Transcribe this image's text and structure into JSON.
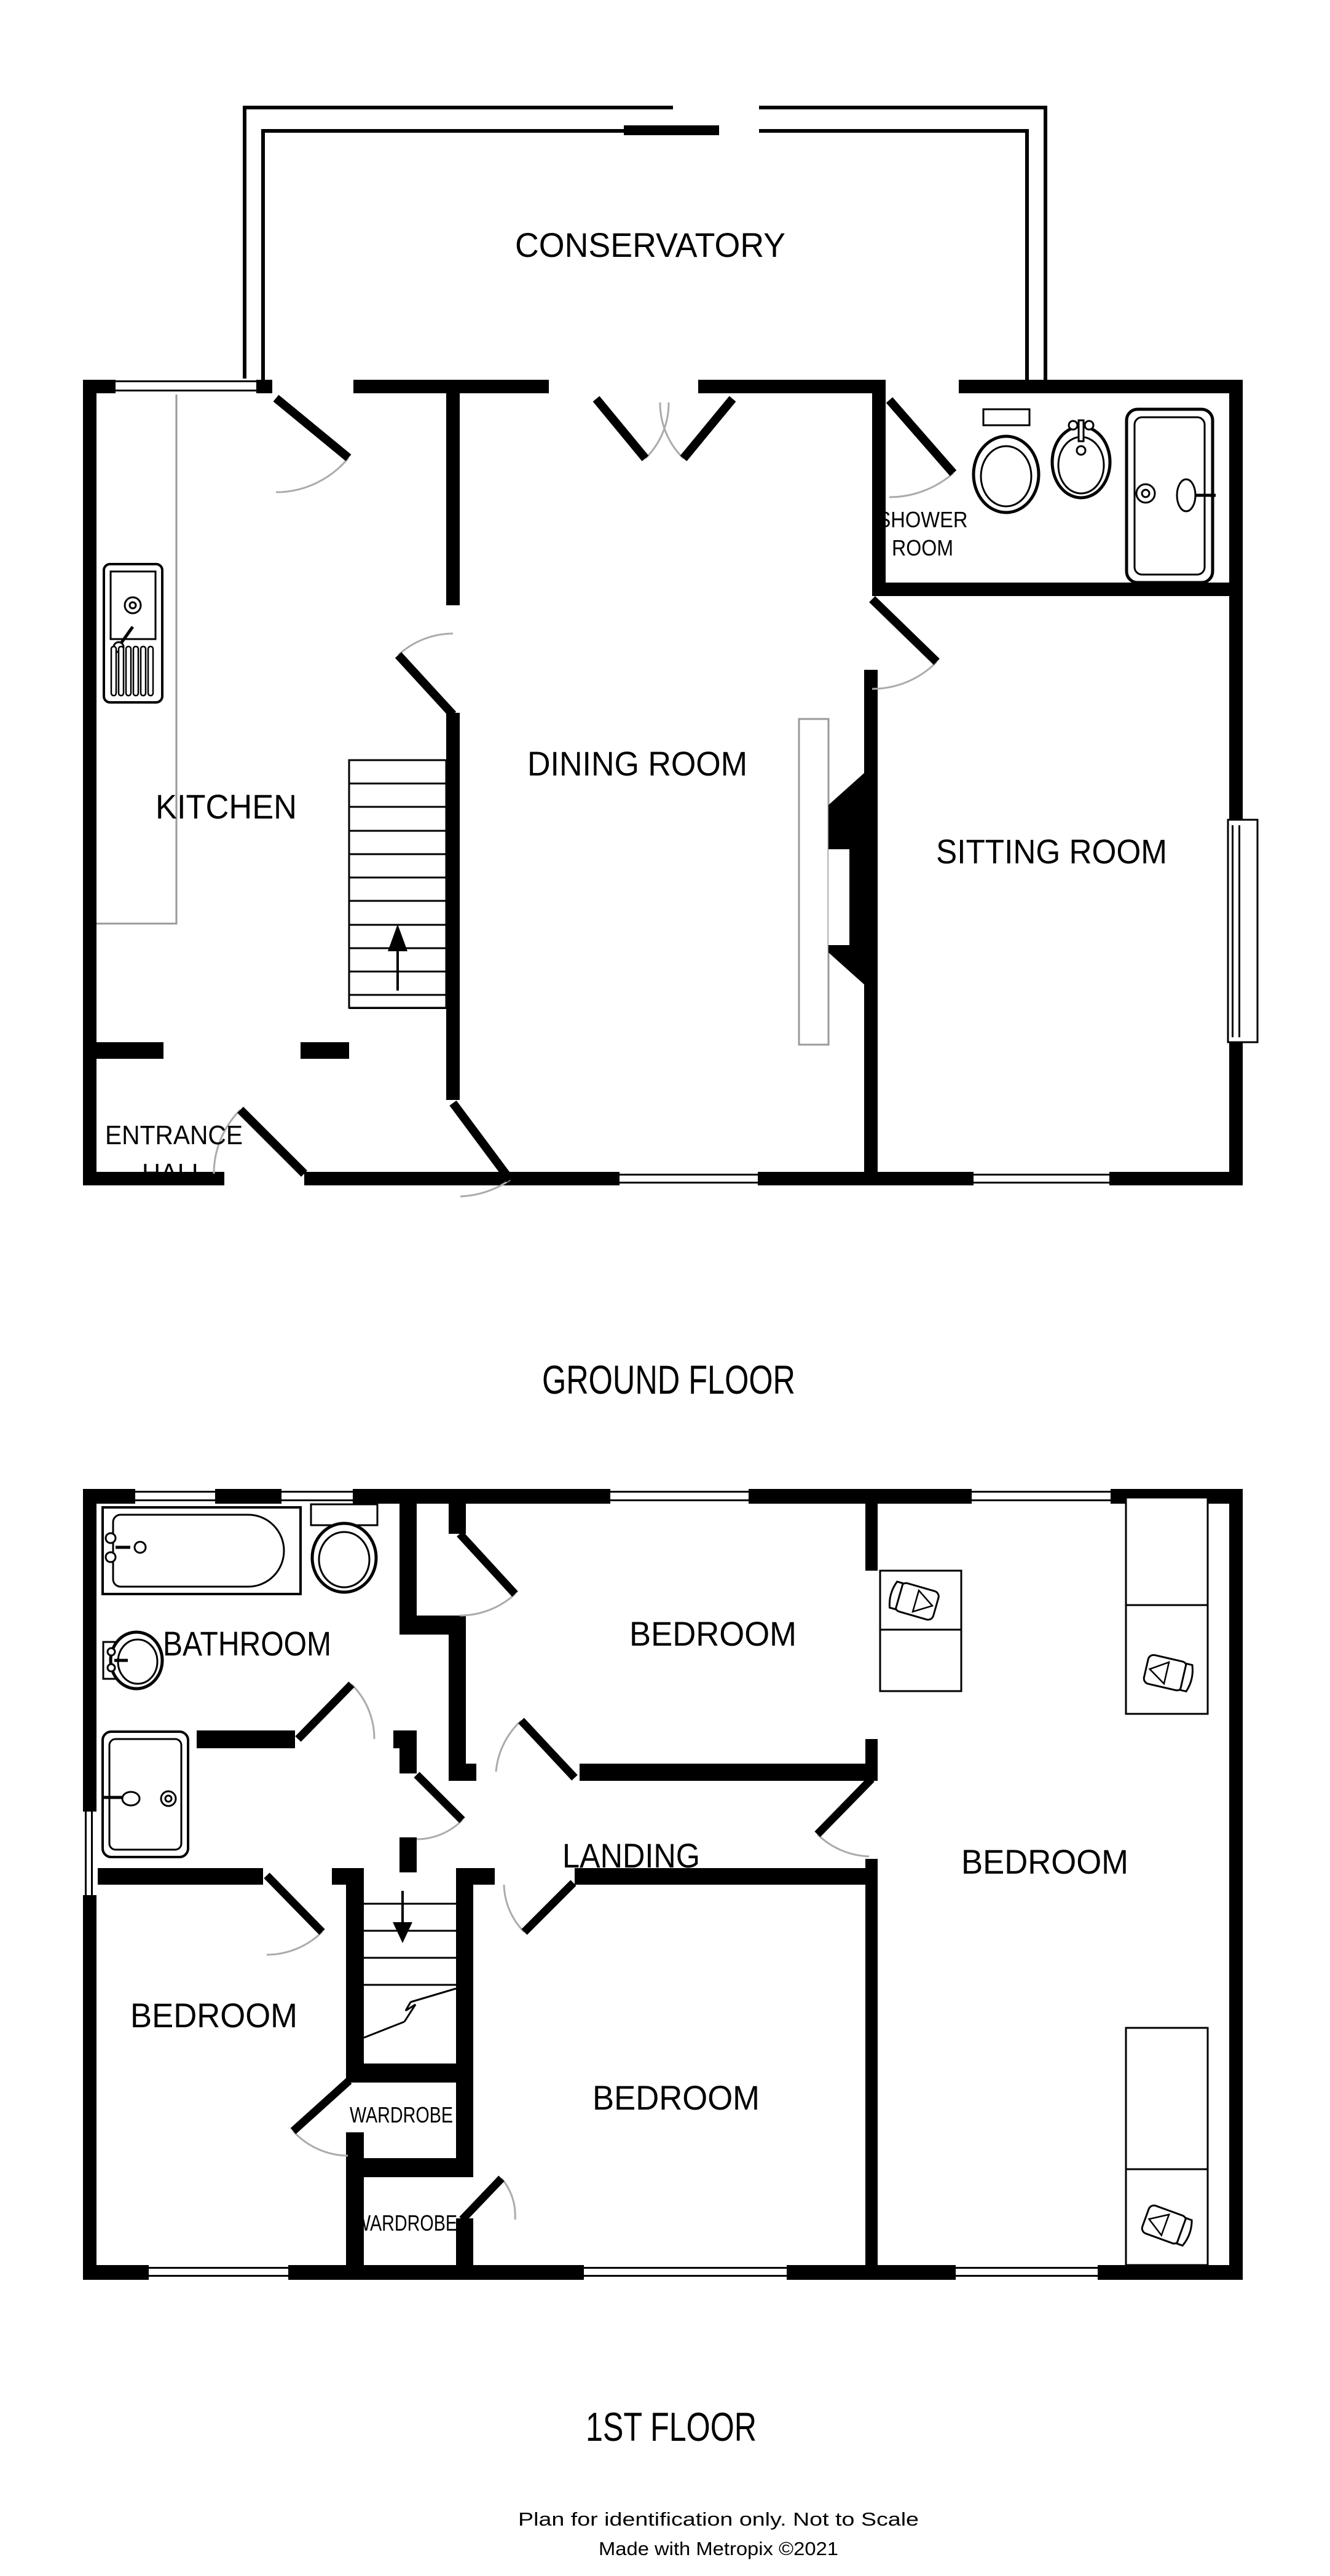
{
  "plan": {
    "type": "floor-plan",
    "colors": {
      "wall": "#000000",
      "background": "#ffffff",
      "door_arc": "#ababab",
      "counter": "#9a9a9a"
    }
  },
  "ground_floor": {
    "title": "GROUND FLOOR",
    "rooms": {
      "conservatory": "CONSERVATORY",
      "kitchen": "KITCHEN",
      "dining": "DINING ROOM",
      "sitting": "SITTING ROOM",
      "shower1": "SHOWER",
      "shower2": "ROOM",
      "hall1": "ENTRANCE",
      "hall2": "HALL"
    }
  },
  "first_floor": {
    "title": "1ST FLOOR",
    "rooms": {
      "bathroom": "BATHROOM",
      "bedroom_top": "BEDROOM",
      "bedroom_right": "BEDROOM",
      "bedroom_left": "BEDROOM",
      "bedroom_middle": "BEDROOM",
      "landing": "LANDING",
      "wardrobe_upper": "WARDROBE",
      "wardrobe_lower": "WARDROBE"
    }
  },
  "footer": {
    "line1": "Plan for identification only. Not to Scale",
    "line2": "Made with Metropix ©2021"
  }
}
